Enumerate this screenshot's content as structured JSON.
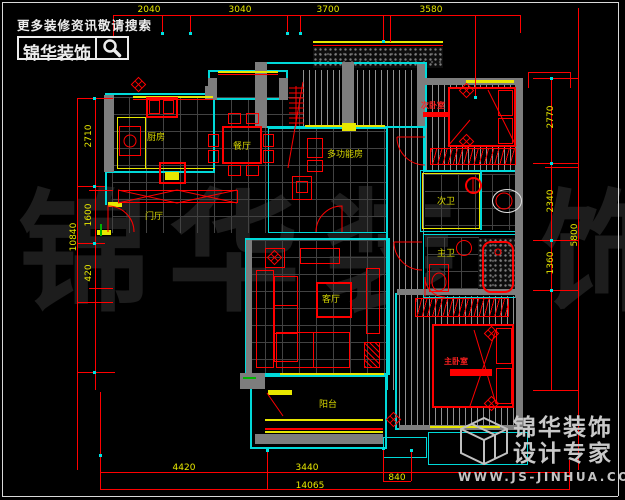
{
  "branding_top": {
    "slogan": "更多装修资讯敬请搜索",
    "logo": "锦华装饰"
  },
  "branding_bottom": {
    "line1": "锦华装饰",
    "line2": "设计专家",
    "url": "WWW.JS-JINHUA.COM"
  },
  "watermark": {
    "c0": "锦",
    "c1": "华",
    "c2": "装",
    "c3": "饰"
  },
  "rooms": {
    "kitchen": "厨房",
    "dining": "餐厅",
    "multi": "多功能房",
    "foyer": "门厅",
    "living": "客厅",
    "balcony": "阳台",
    "bed2": "次卧室",
    "bath2": "次卫",
    "bath1": "主卫",
    "bed1": "主卧室"
  },
  "dims": {
    "top": [
      "2040",
      "3040",
      "3700",
      "3580"
    ],
    "left": [
      "2710",
      "1600",
      "420"
    ],
    "left_total": "10840",
    "right": [
      "2770",
      "2340",
      "1360"
    ],
    "right_total": "5800",
    "bottom": [
      "4420",
      "3440",
      "840"
    ],
    "bottom_total": "14065"
  },
  "colors": {
    "wall": "#00d9d9",
    "fixture": "#ff0000",
    "dim_text": "#e8e800",
    "brand_gray": "#c9c9c9"
  }
}
